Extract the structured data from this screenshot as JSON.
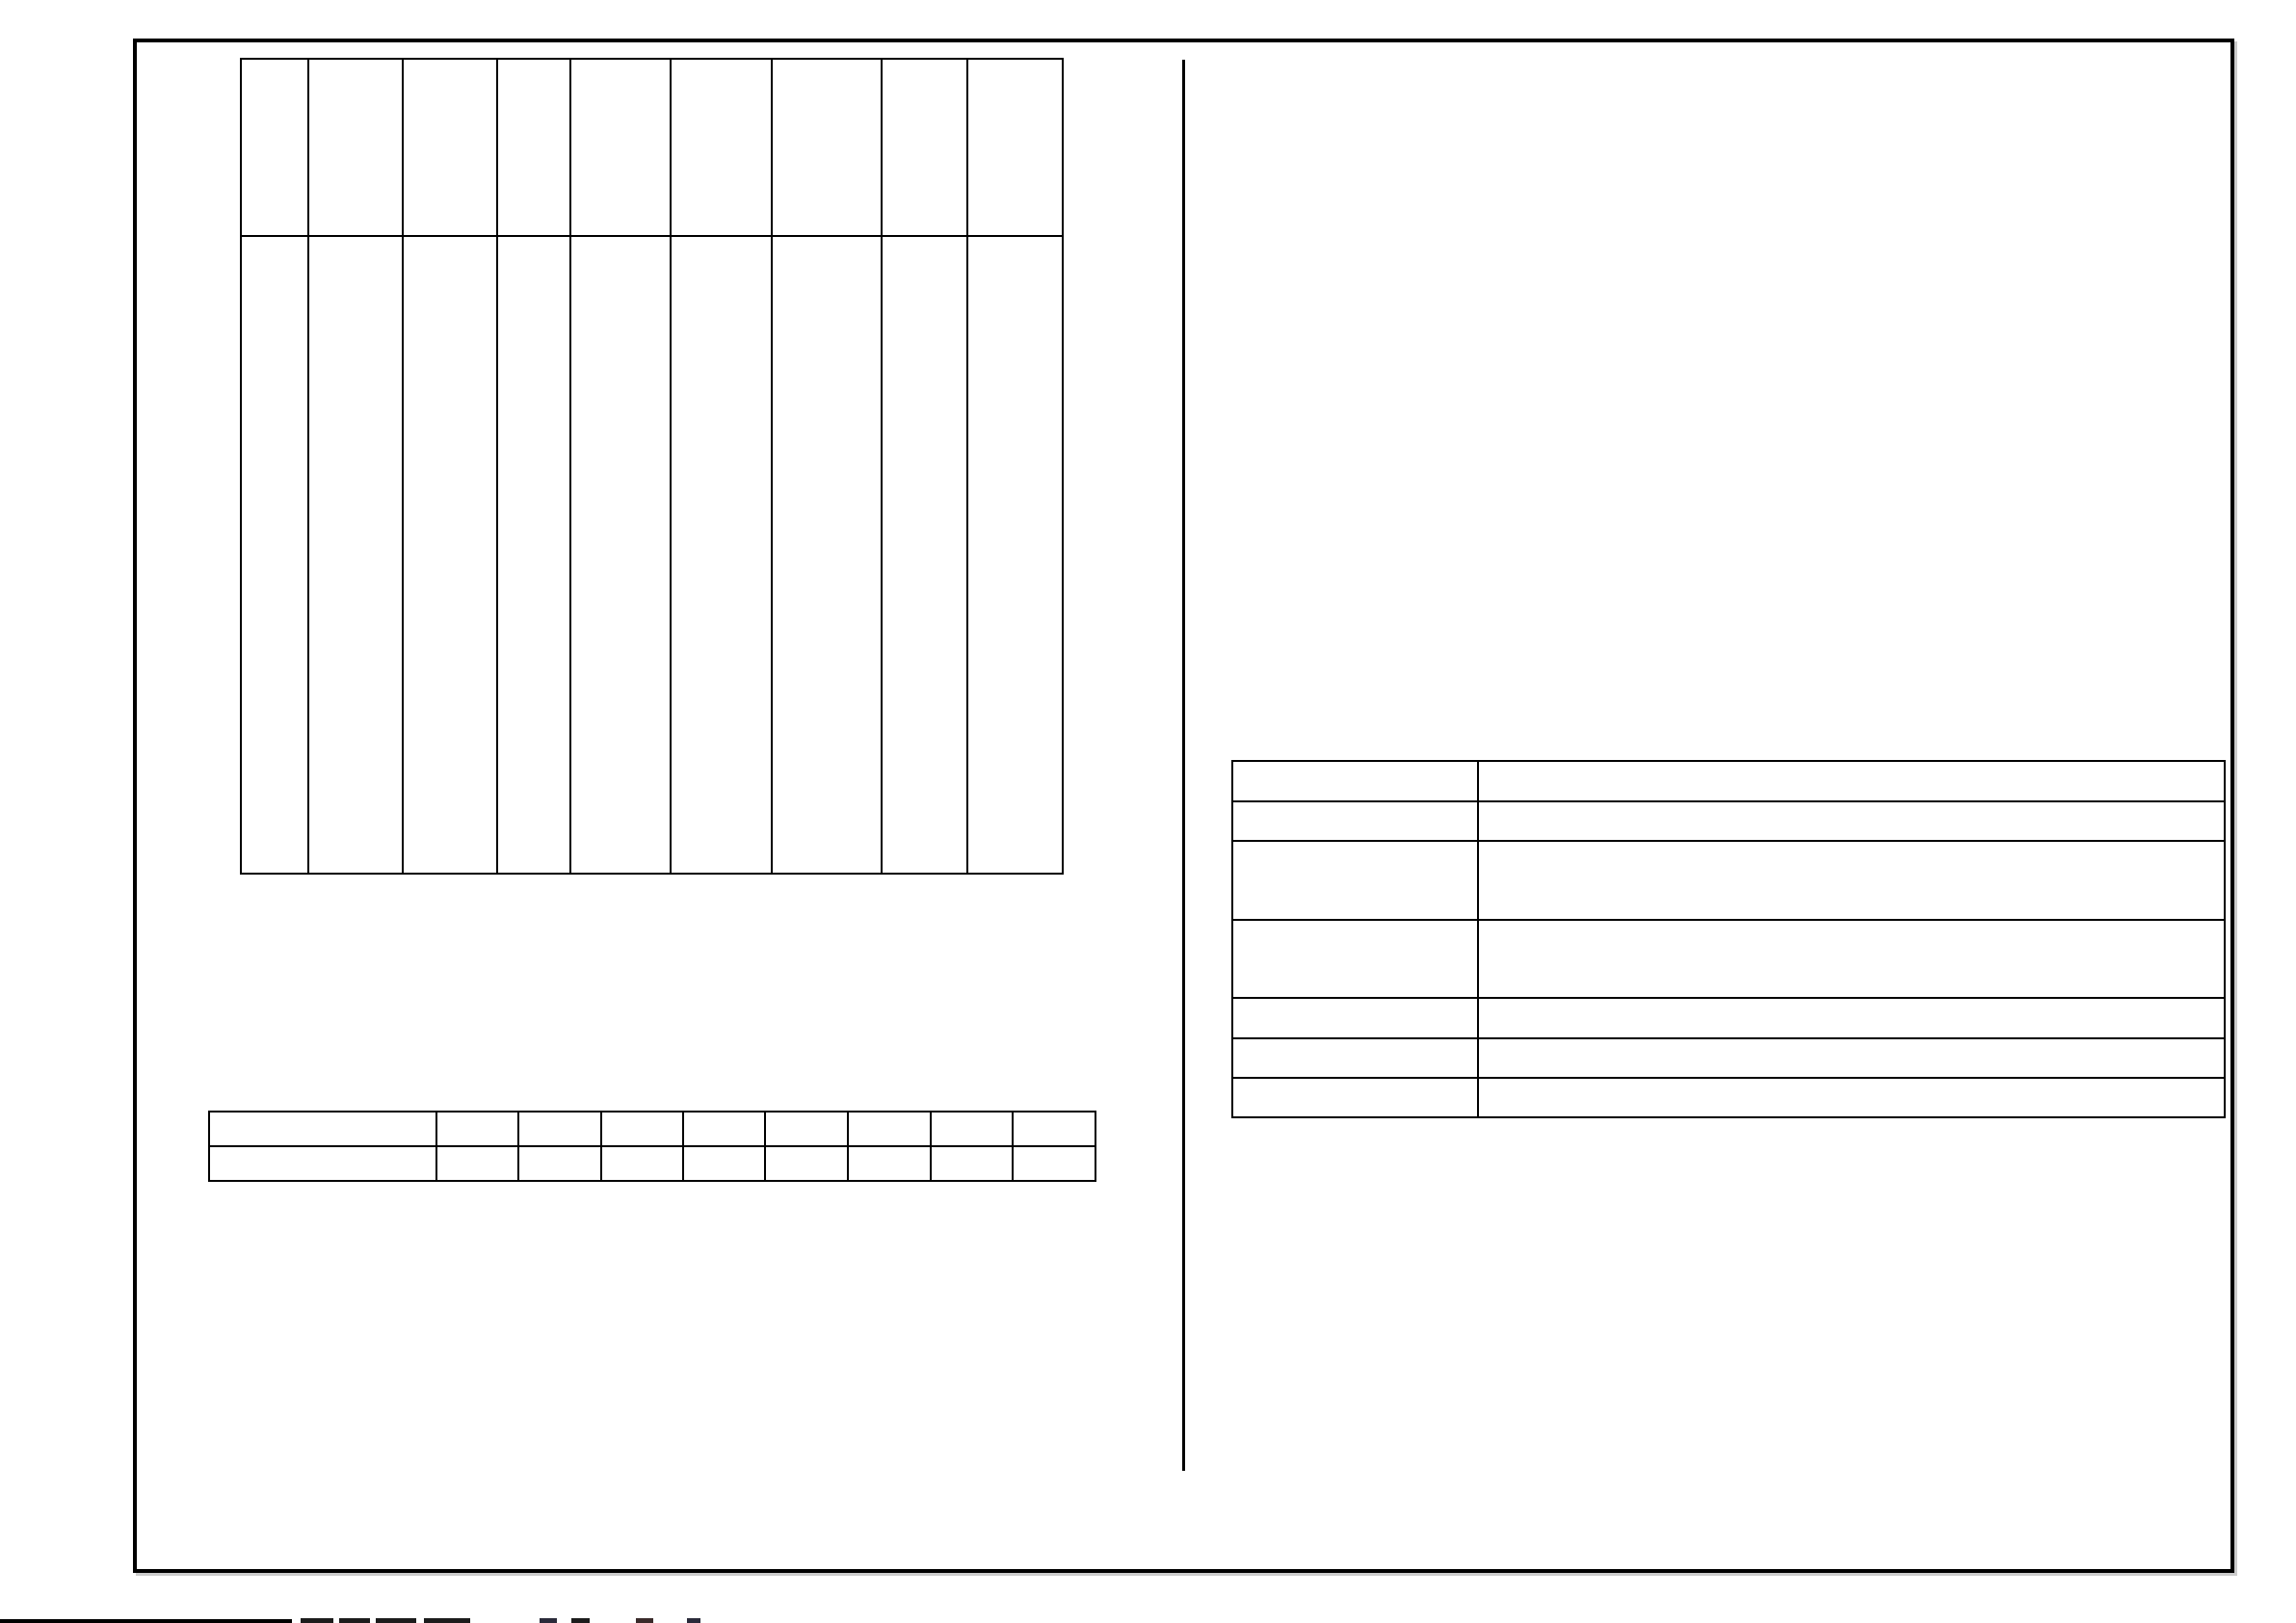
{
  "sheet": {
    "description_label": "",
    "colors": {
      "background": "#ffffff",
      "line": "#000000",
      "border_shadow": "#cccccc"
    }
  },
  "schedule_table": {
    "columns": 9,
    "rows": 2,
    "header": [
      "",
      "",
      "",
      "",
      "",
      "",
      "",
      "",
      ""
    ],
    "body": [
      [
        "",
        "",
        "",
        "",
        "",
        "",
        "",
        "",
        ""
      ]
    ]
  },
  "notes_table": {
    "columns": 2,
    "rows": 7,
    "cells": [
      [
        "",
        ""
      ],
      [
        "",
        ""
      ],
      [
        "",
        ""
      ],
      [
        "",
        ""
      ],
      [
        "",
        ""
      ],
      [
        "",
        ""
      ],
      [
        "",
        ""
      ]
    ]
  },
  "strip_table": {
    "columns": 9,
    "rows": 2,
    "cells": [
      [
        "",
        "",
        "",
        "",
        "",
        "",
        "",
        "",
        ""
      ],
      [
        "",
        "",
        "",
        "",
        "",
        "",
        "",
        "",
        ""
      ]
    ]
  },
  "footer": {
    "truncated_text": ""
  }
}
